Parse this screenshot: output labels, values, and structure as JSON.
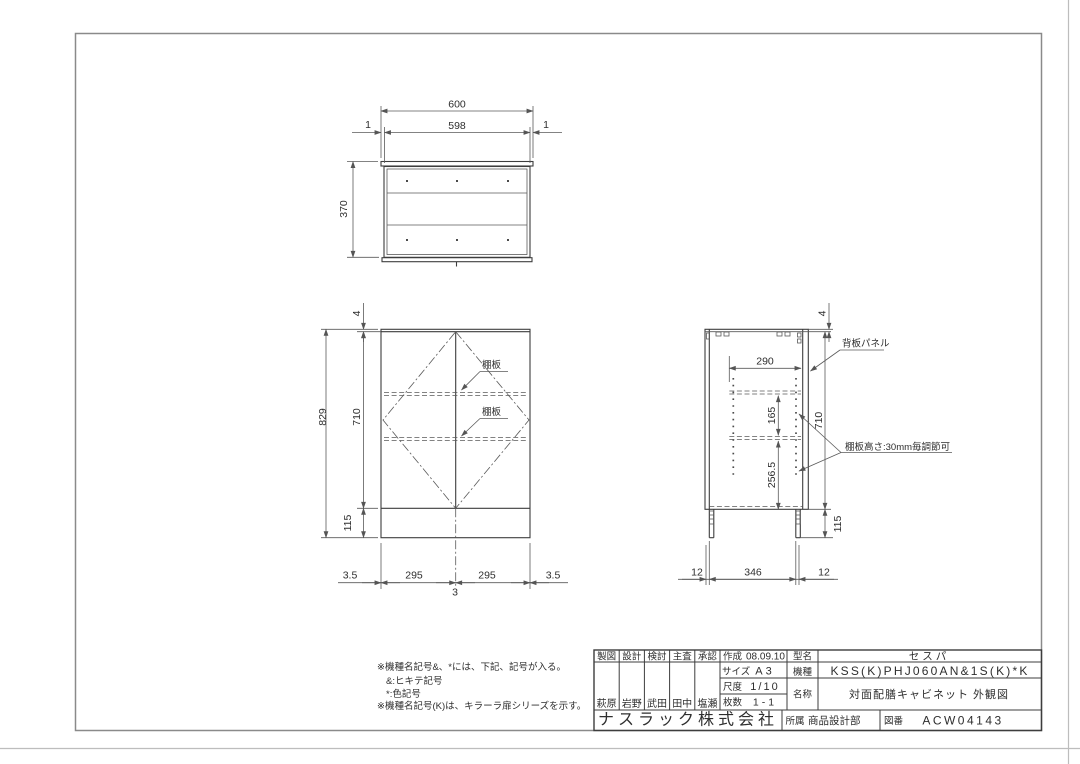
{
  "colors": {
    "object_line": "#3d3d3d",
    "dim_line": "#5a5a5a",
    "text": "#2e2e2e",
    "border": "#8a8a8a"
  },
  "top_view": {
    "dims": {
      "outer_width": "600",
      "inner_width": "598",
      "left_gap": "1",
      "right_gap": "1",
      "depth": "370"
    }
  },
  "front_view": {
    "dims": {
      "top_thickness": "4",
      "total_height": "829",
      "body_height": "710",
      "base_height": "115",
      "left_edge": "3.5",
      "left_door": "295",
      "right_door": "295",
      "right_edge": "3.5",
      "center_gap": "3"
    },
    "labels": {
      "shelf_upper": "棚板",
      "shelf_lower": "棚板"
    }
  },
  "side_view": {
    "dims": {
      "top_thickness": "4",
      "inner_depth": "290",
      "shelf_pitch": "165",
      "lower_clear": "256.5",
      "body_height": "710",
      "base_height": "115",
      "base_front": "12",
      "base_depth": "346",
      "base_rear": "12"
    },
    "labels": {
      "back_panel": "背板パネル",
      "shelf_note": "棚板高さ:30mm毎調節可"
    }
  },
  "notes": {
    "line1": "※機種名記号&、*には、下記、記号が入る。",
    "line2": "&:ヒキテ記号",
    "line3": "*:色記号",
    "line4": "※機種名記号(K)は、キラーラ扉シリーズを示す。"
  },
  "title_block": {
    "headers": [
      "製図",
      "設計",
      "検討",
      "主査",
      "承認"
    ],
    "names": [
      "萩原",
      "岩野",
      "武田",
      "田中",
      "塩瀬"
    ],
    "created_label": "作成",
    "created_date": "08.09.10",
    "size_label": "サイズ",
    "size_value": "A3",
    "scale_label": "尺度",
    "scale_value": "1/10",
    "sheets_label": "枚数",
    "sheets_value": "1-1",
    "model_label": "型名",
    "model_value": "セスパ",
    "machine_label": "機種",
    "machine_value": "KSS(K)PHJ060AN&1S(K)*K",
    "name_label": "名称",
    "name_value": "対面配膳キャビネット 外観図",
    "company": "ナスラック株式会社",
    "dept_label": "所属",
    "dept_value": "商品設計部",
    "drawing_no_label": "図番",
    "drawing_no_value": "ACW04143"
  }
}
